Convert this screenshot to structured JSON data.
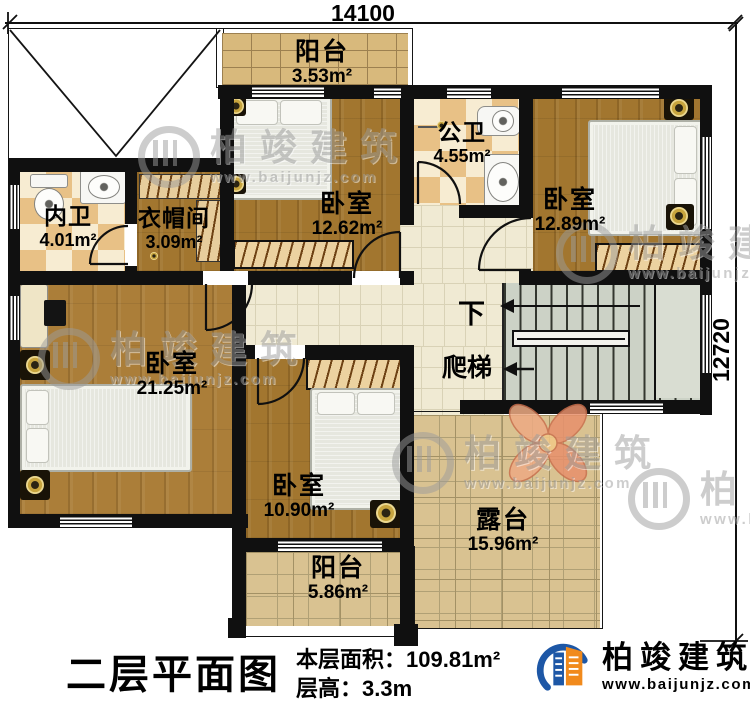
{
  "dimensions": {
    "width_mm": "14100",
    "depth_mm": "12720"
  },
  "rooms": [
    {
      "id": "balcony-top",
      "name": "阳台",
      "area": "3.53m²"
    },
    {
      "id": "public-bath",
      "name": "公卫",
      "area": "4.55m²"
    },
    {
      "id": "bedroom-middle",
      "name": "卧室",
      "area": "12.62m²"
    },
    {
      "id": "bedroom-right",
      "name": "卧室",
      "area": "12.89m²"
    },
    {
      "id": "ensuite-bath",
      "name": "内卫",
      "area": "4.01m²"
    },
    {
      "id": "cloakroom",
      "name": "衣帽间",
      "area": "3.09m²"
    },
    {
      "id": "bedroom-left",
      "name": "卧室",
      "area": "21.25m²"
    },
    {
      "id": "bedroom-bottom",
      "name": "卧室",
      "area": "10.90m²"
    },
    {
      "id": "terrace",
      "name": "露台",
      "area": "15.96m²"
    },
    {
      "id": "balcony-bottom",
      "name": "阳台",
      "area": "5.86m²"
    }
  ],
  "stairs": {
    "direction_label": "下",
    "ladder_label": "爬梯"
  },
  "footer": {
    "title": "二层平面图",
    "floor_area_label": "本层面积：",
    "floor_area_value": "109.81m²",
    "floor_height_label": "层高：",
    "floor_height_value": "3.3m"
  },
  "brand": {
    "name": "柏竣建筑",
    "website": "www.baijunjz.com"
  },
  "watermark": {
    "name": "柏竣建筑",
    "website": "www.baijunjz.com"
  },
  "colors": {
    "wall": "#101010",
    "brand_blue": "#1d57a6",
    "brand_orange": "#f18a1c"
  }
}
